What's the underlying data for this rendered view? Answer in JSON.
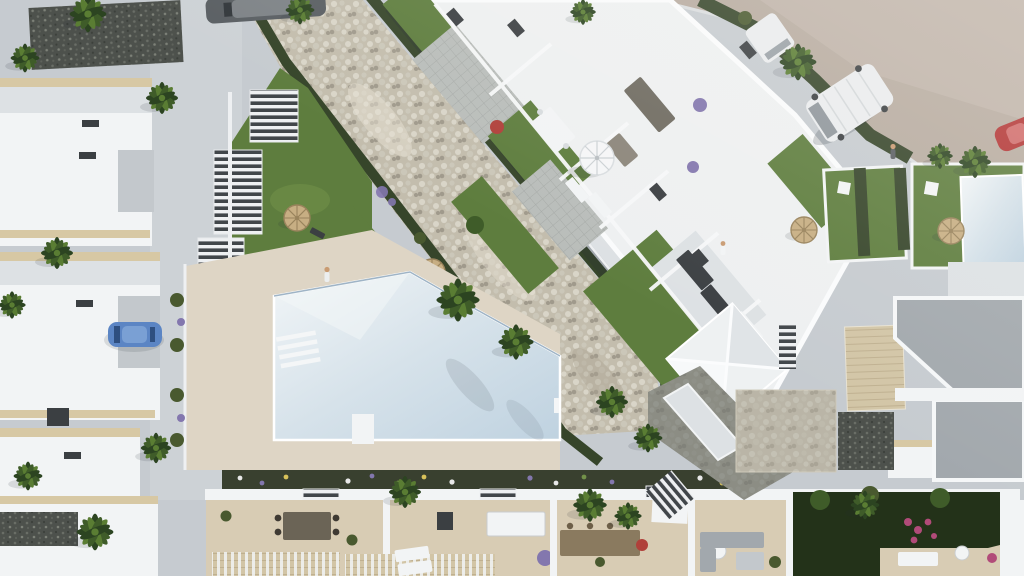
{
  "scene": {
    "description": "aerial-3d-render-of-mediterranean-residential-complex",
    "palette": {
      "pavement": "#c6cbd0",
      "pavementLight": "#d4d8db",
      "roadTan": "#b7aba0",
      "roadTanLight": "#c8bcb1",
      "curb": "#dadddf",
      "stoneBase": "#cfc8b6",
      "stoneLight": "#e7e1d3",
      "stoneMid": "#d8d2c2",
      "stoneDark": "#aaa292",
      "hedgeDark": "#36452a",
      "hedgeMid": "#49592f",
      "lawn": "#5e7d3e",
      "lawnLight": "#729149",
      "lawnDark": "#46602f",
      "foliageDark": "#233219",
      "palmDark": "#2c4421",
      "palmMid": "#3f5c29",
      "palmLight": "#5a7d33",
      "white": "#f2f4f5",
      "wallShade": "#dde1e4",
      "wallDark": "#c3c8cc",
      "trimBeige": "#d7c8a4",
      "roofGray": "#a2a8ad",
      "tileGray": "#b9bdba",
      "gravelDark": "#4d514c",
      "chimneyDark": "#3b3f42",
      "strawTan": "#c7ae83",
      "strawDark": "#99835c",
      "deckCream": "#ded5c5",
      "terraceFloor": "#d8ccb4",
      "deckWood": "#d2c5a6",
      "poolLight": "#eef3f5",
      "poolBlue": "#c3d4e1",
      "masonry": "#6f746f",
      "purple": "#8377ae",
      "pinkFlower": "#b14b79",
      "redFlower": "#b0403a",
      "yellowFlower": "#d8c25a",
      "carBlue": "#5b85c4",
      "carBlueRoof": "#7aa0d4",
      "carRed": "#b23434",
      "vanWhite": "#eaecee",
      "sedanDark": "#5a5f63",
      "skin": "#c99b72",
      "shadow": "rgba(35,45,55,0.22)",
      "shadowSoft": "rgba(35,45,55,0.13)"
    },
    "inventory": {
      "palm_trees": 20,
      "straw_parasols": 6,
      "white_parasols": 1,
      "swimming_pools": 2,
      "pyramid_gazebos": 1,
      "staircases": 6,
      "people": 3,
      "vehicles": [
        {
          "name": "white-van",
          "color": "#eaecee"
        },
        {
          "name": "small-white-van",
          "color": "#eaecee"
        },
        {
          "name": "blue-car",
          "color": "#5b85c4"
        },
        {
          "name": "red-car",
          "color": "#b23434"
        },
        {
          "name": "dark-sedan",
          "color": "#5a5f63"
        }
      ],
      "landscape_features": [
        "dry-stone-river",
        "hedge-rows",
        "communal-lawn",
        "pool-deck",
        "row-houses-west",
        "central-apartment-block",
        "roof-gardens",
        "terrace-row-south",
        "sand-road-east",
        "private-gardens-east"
      ]
    }
  }
}
